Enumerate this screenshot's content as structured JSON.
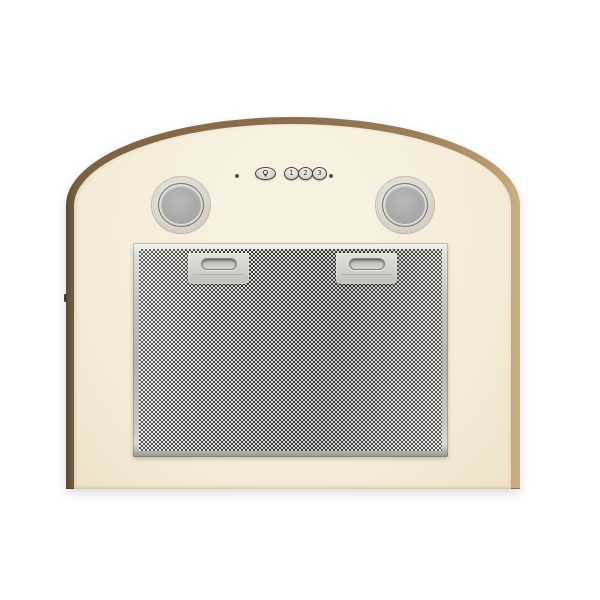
{
  "scene": {
    "description": "Front view of an arched kitchen cooker hood: cream enamel body with brown edge trim, two round lamps, push-button controls and an aluminium mesh grease filter",
    "background_color": "#ffffff"
  },
  "hood": {
    "body_color": "#f4ecd8",
    "trim_colors": {
      "left": "#6e5638",
      "top": "#8b6f4d",
      "right": "#c2a67c"
    }
  },
  "control_panel": {
    "left_indicator": {
      "name": "indicator-led",
      "color": "#55544c"
    },
    "light_button": {
      "icon": "lamp-icon"
    },
    "speed_buttons": [
      {
        "label": "1"
      },
      {
        "label": "2"
      },
      {
        "label": "3"
      }
    ],
    "right_indicator": {
      "name": "indicator-led",
      "color": "#55544c"
    }
  },
  "lamps": {
    "count": 2,
    "glass_color": "#a8aaa9",
    "ring_color": "#d9d6d0"
  },
  "filter": {
    "type": "aluminium mesh grease filter",
    "frame_color": "#c9c8c4",
    "mesh_colors": {
      "dark": "#3f3f3d",
      "light": "#e4e3df"
    },
    "handle_count": 2
  }
}
